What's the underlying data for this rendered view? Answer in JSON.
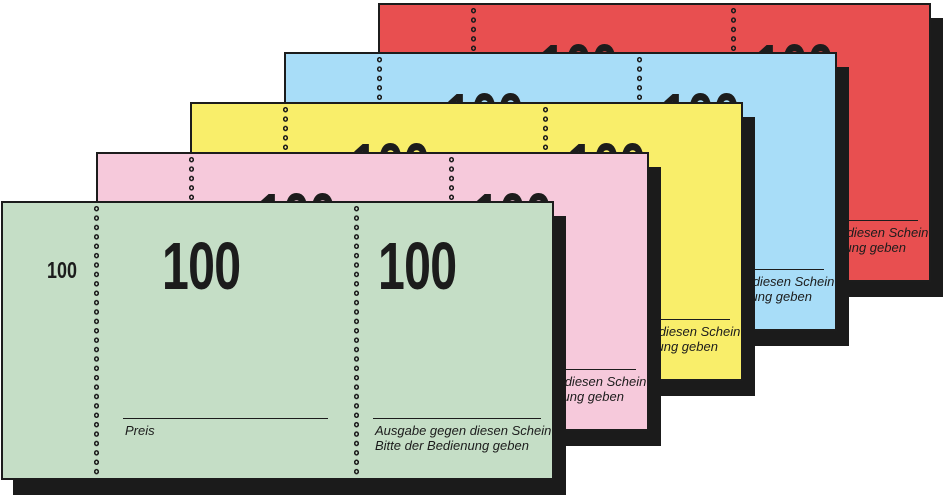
{
  "product": {
    "description": "Stack of five numbered coupon pads",
    "stub_number": "100",
    "coupon_number": "100",
    "price_label": "Preis",
    "issue_line1": "Ausgabe gegen diesen Schein",
    "issue_line2": "Bitte der Bedienung geben"
  },
  "colors": {
    "ink": "#1c1c1c",
    "shadow": "#1b1b1b",
    "background": "#ffffff"
  },
  "tickets": [
    {
      "id": "red",
      "color": "#e84f50"
    },
    {
      "id": "blue",
      "color": "#a8ddf8"
    },
    {
      "id": "yellow",
      "color": "#f9ee6a"
    },
    {
      "id": "pink",
      "color": "#f6c9db"
    },
    {
      "id": "green",
      "color": "#c5dec6"
    }
  ]
}
